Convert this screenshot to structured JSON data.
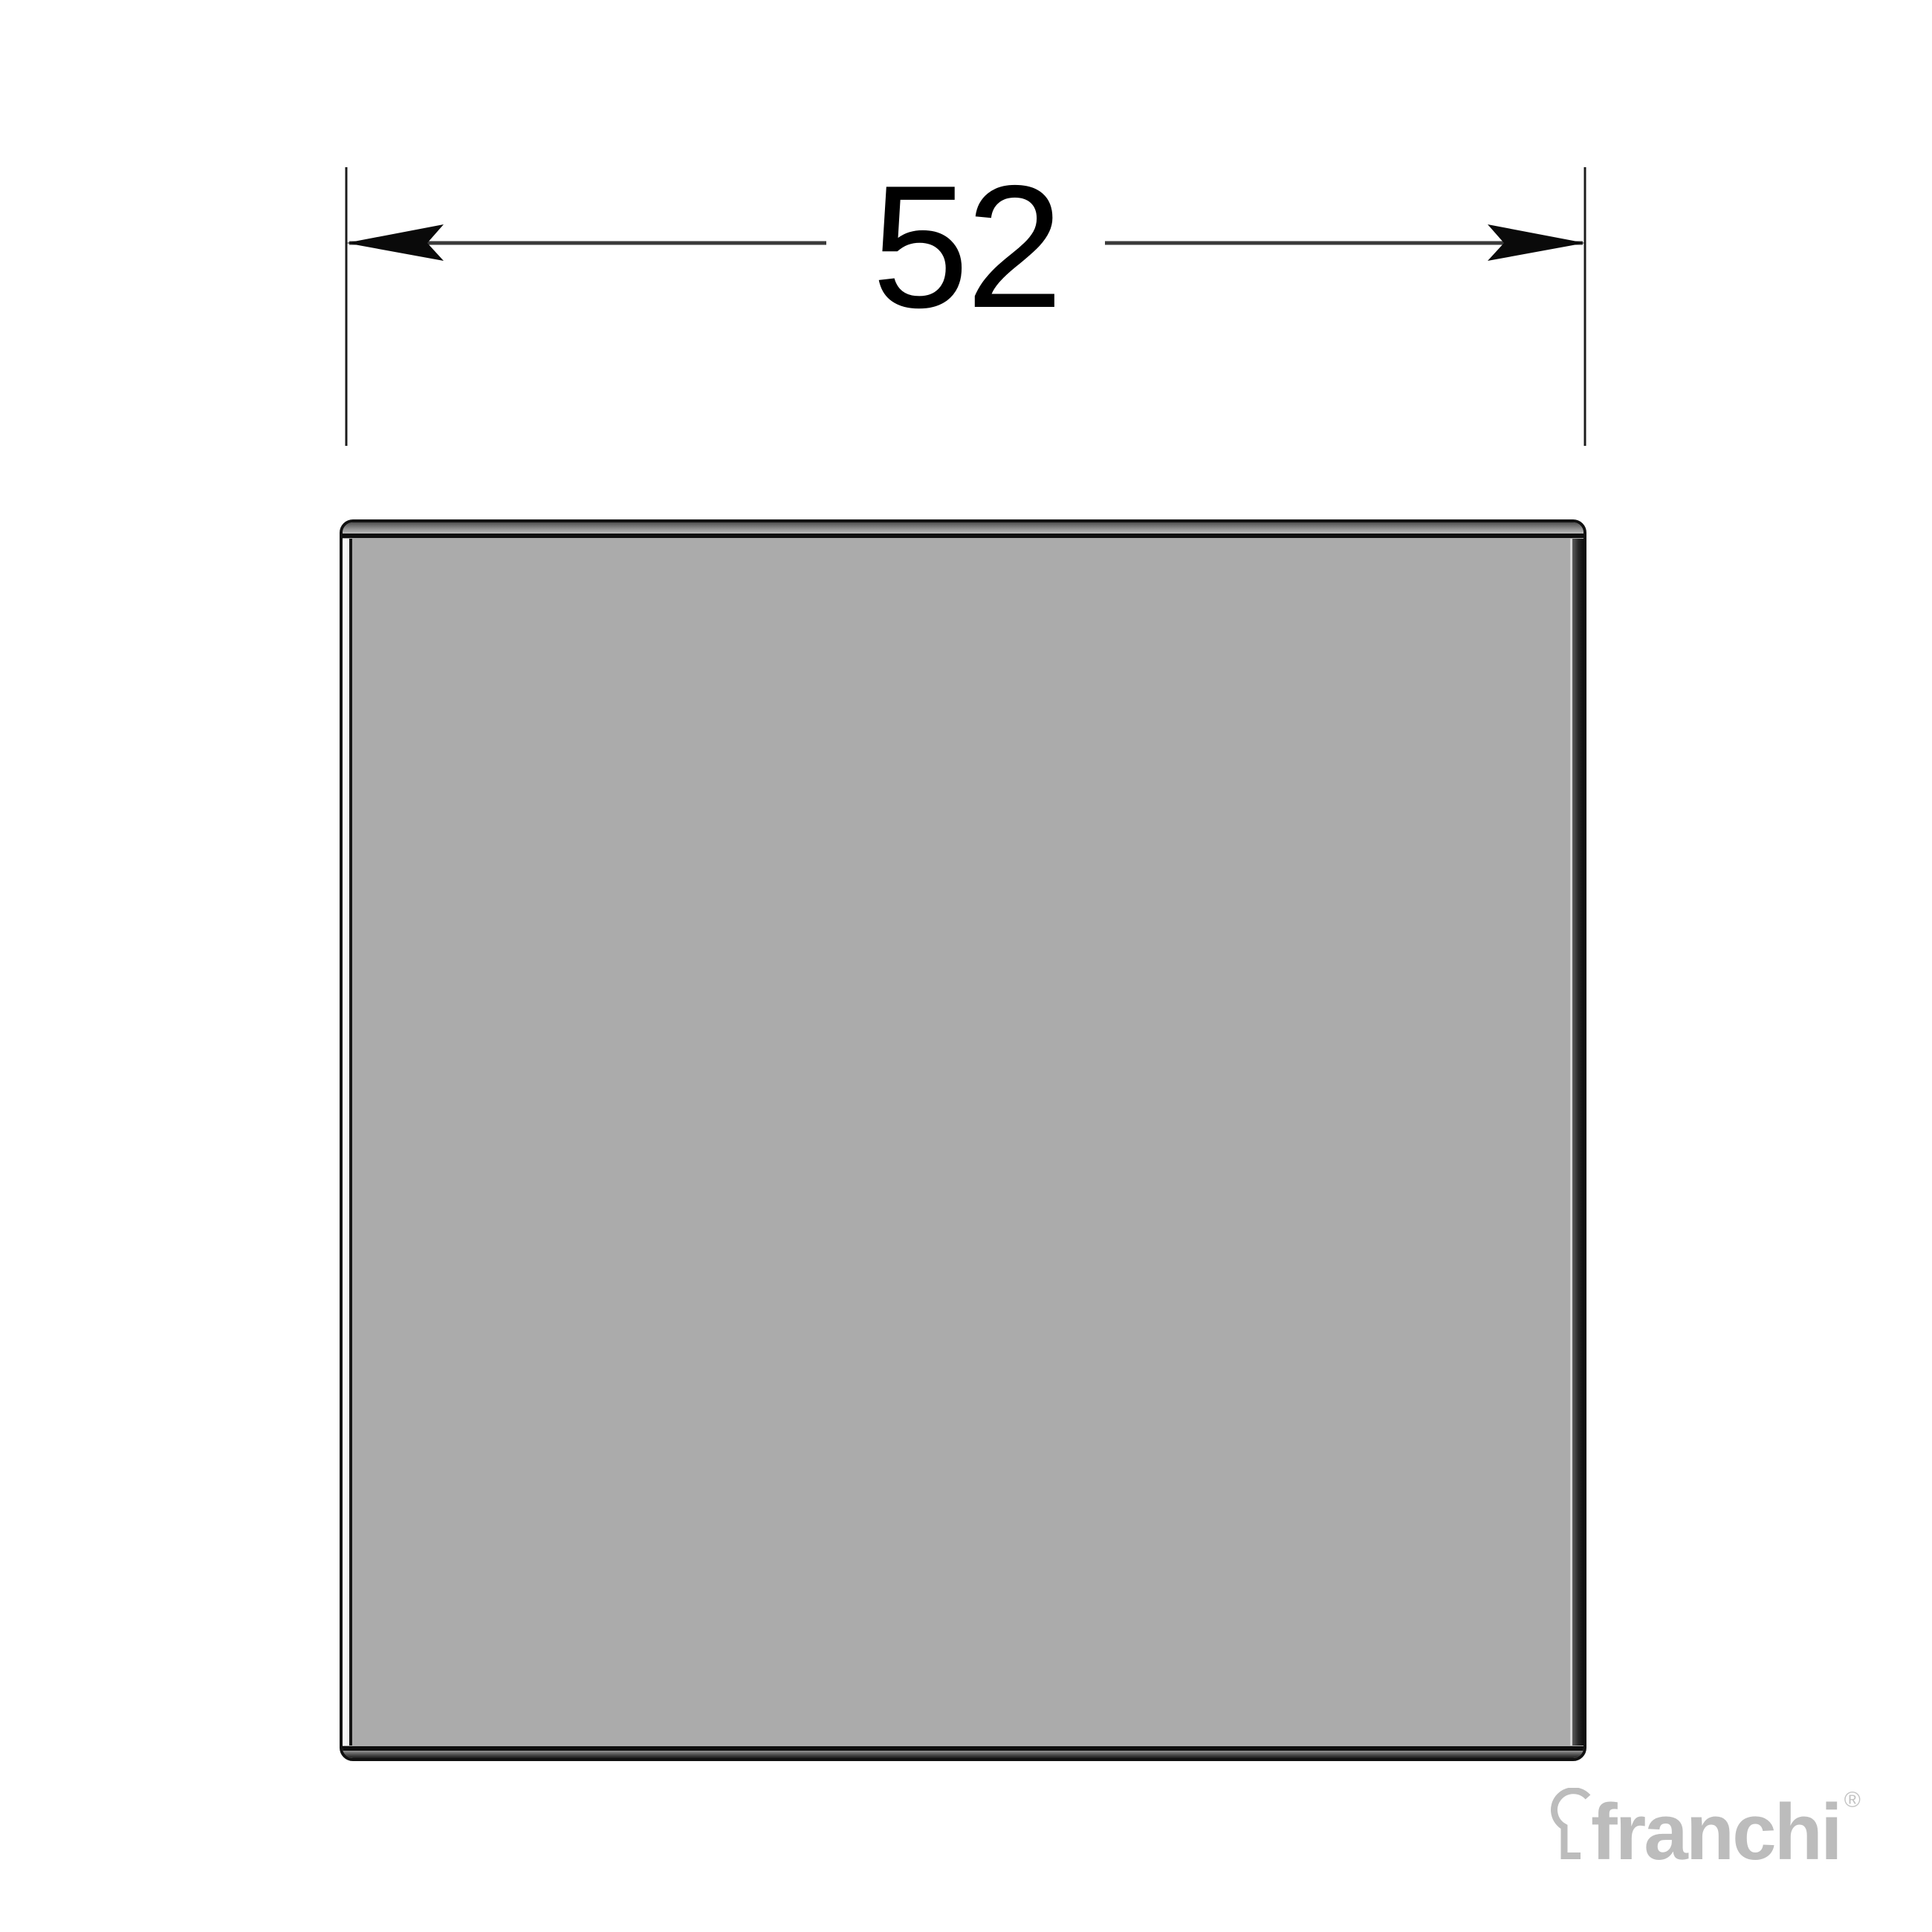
{
  "diagram": {
    "type": "technical-drawing",
    "dimension": {
      "value": "52",
      "orientation": "horizontal",
      "line_color": "#333333",
      "arrow_color": "#0a0a0a"
    },
    "part": {
      "shape": "square-end-cap",
      "fill_color": "#ababab",
      "outline_color": "#111111",
      "top_bevel_gradient": [
        "#4e4e4e",
        "#bcbcbc"
      ],
      "left_bevel_color": "#f2f2f2",
      "right_bevel_gradient": [
        "#5a5a5a",
        "#101010"
      ],
      "bottom_bevel_gradient": [
        "#949494",
        "#1c1c1c"
      ]
    },
    "watermark": {
      "brand": "franchi",
      "registered_mark": "®",
      "color": "#bcbcbc",
      "icon": "keyhole-icon"
    }
  }
}
